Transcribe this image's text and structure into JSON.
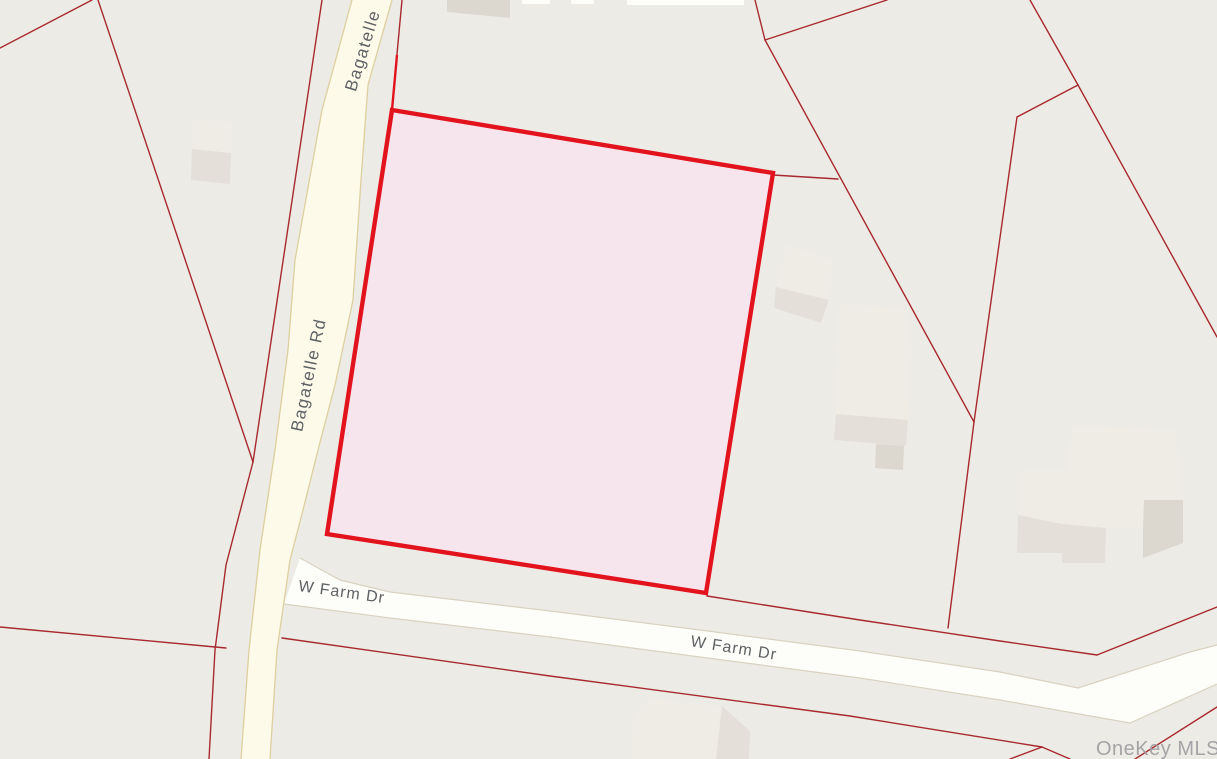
{
  "map": {
    "kind": "mls-parcel-map",
    "labels": {
      "bagatelle_top": {
        "text": "Bagatelle"
      },
      "bagatelle_mid": {
        "text": "Bagatelle Rd"
      },
      "w_farm_1": {
        "text": "W Farm Dr"
      },
      "w_farm_2": {
        "text": "W Farm Dr"
      },
      "watermark": {
        "text": "OneKey MLS"
      }
    },
    "roads": [
      {
        "name": "Bagatelle Rd",
        "style": "minor-yellow"
      },
      {
        "name": "W Farm Dr",
        "style": "local-white"
      }
    ],
    "highlighted_parcel": {
      "shape": "quadrilateral",
      "border_color": "#e3131e",
      "fill_color": "#f7e5ee",
      "location": "northeast corner of Bagatelle Rd and W Farm Dr"
    },
    "colors": {
      "background": "#edebe6",
      "parcel_line": "#a8292e",
      "highlight_border": "#e3131e",
      "highlight_fill": "#f7e5ee",
      "road_yellow": "#fdfaea",
      "road_yellow_border": "#ddcf9e",
      "road_white": "#fdfdfa",
      "label_gray": "#5f6265",
      "watermark_gray": "#9d9da0"
    }
  }
}
